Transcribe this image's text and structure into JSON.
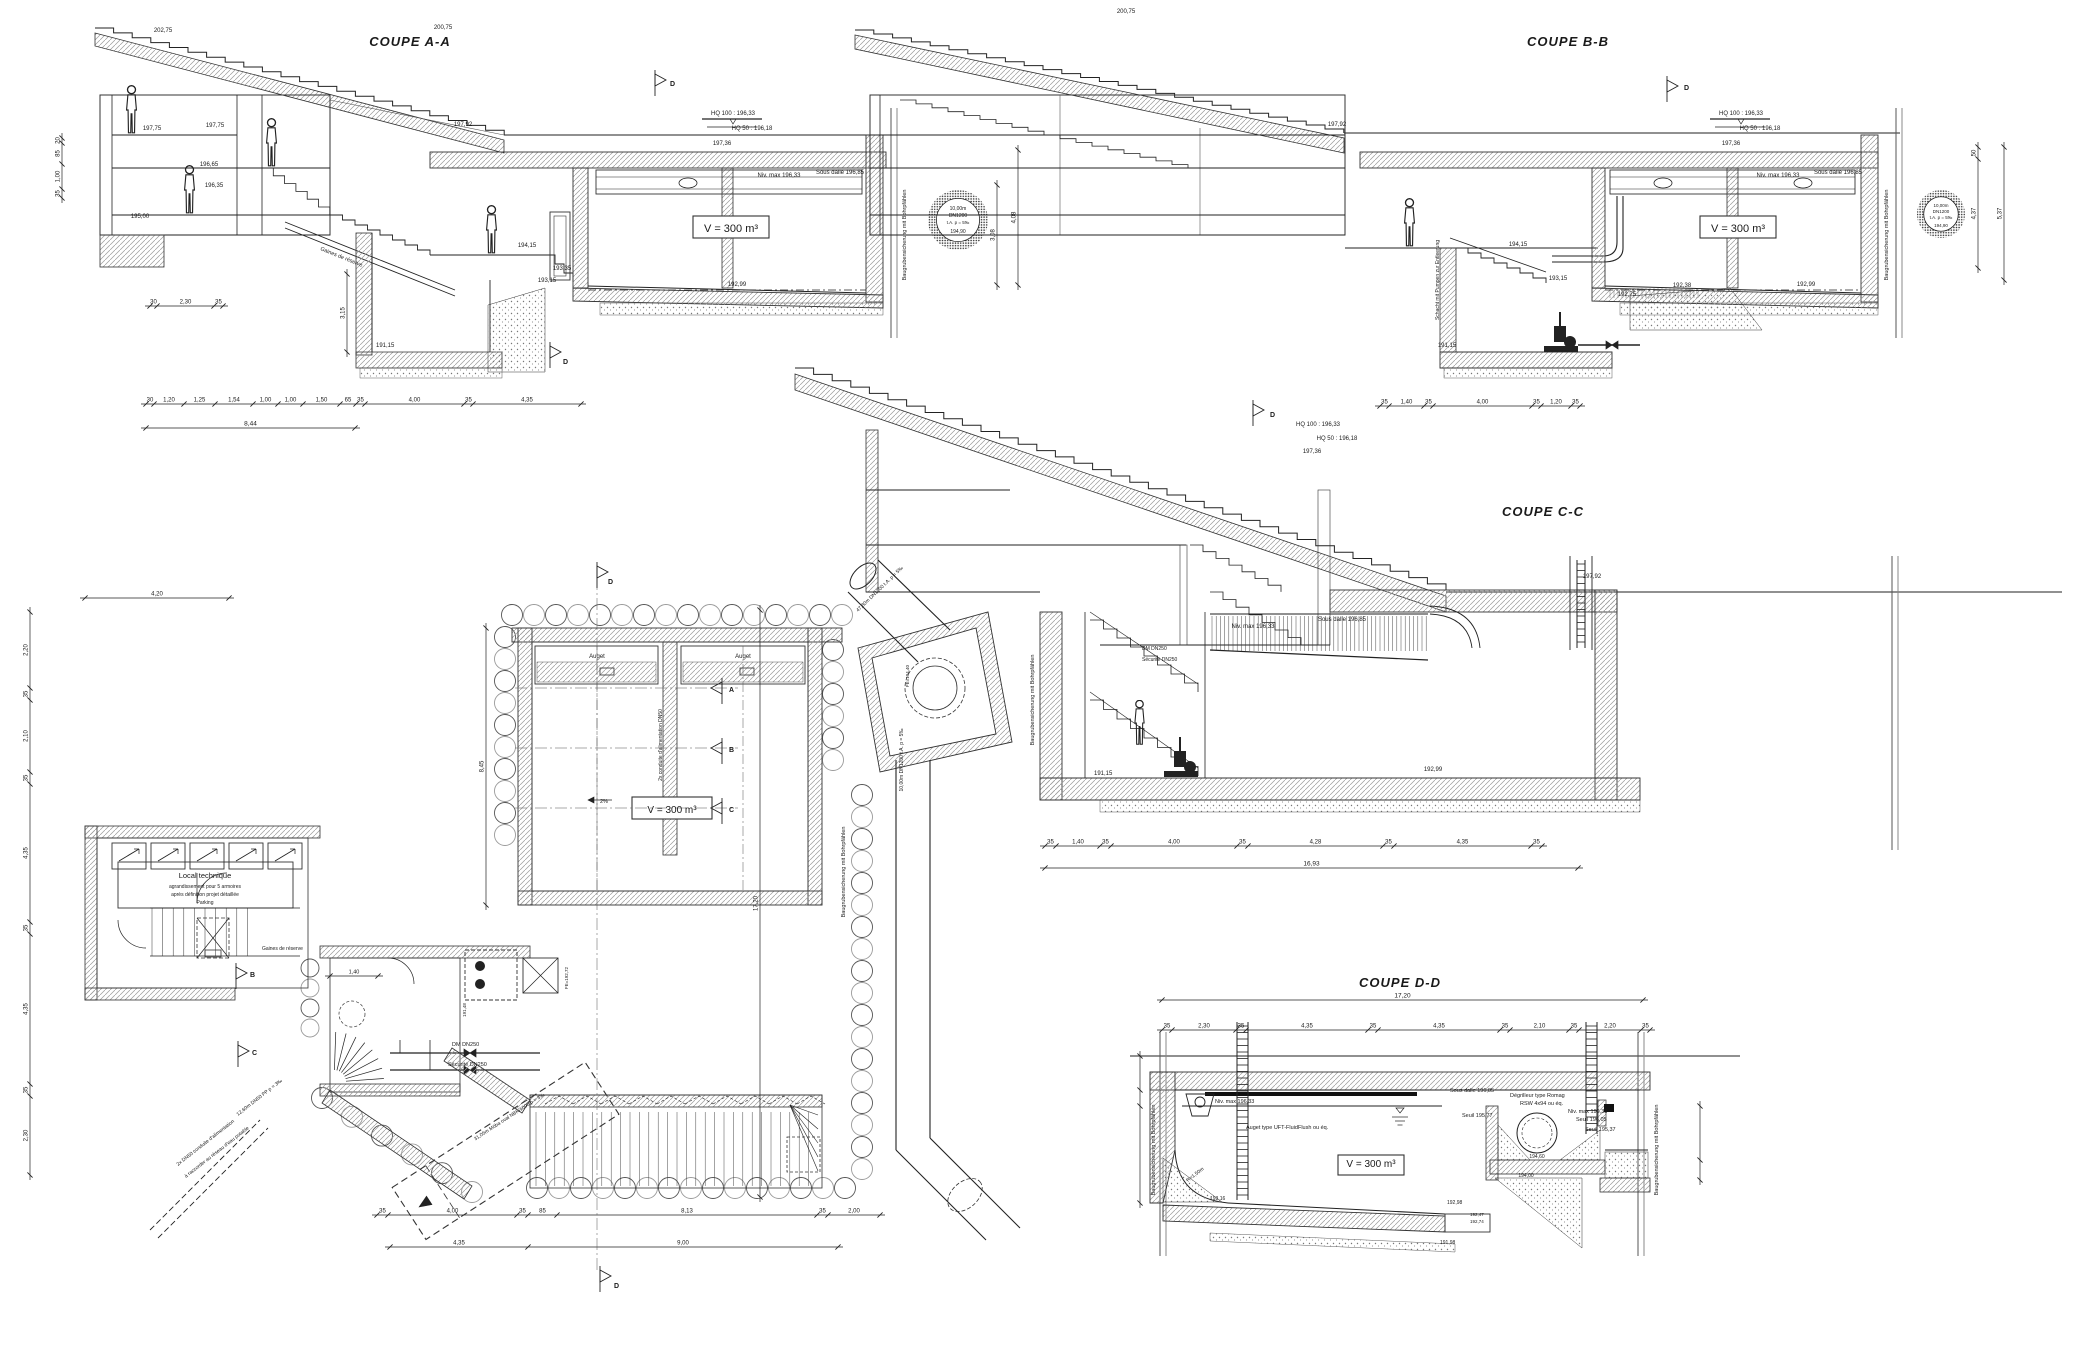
{
  "shared": {
    "volume": "V = 300 m³",
    "niv_max": "Niv. max 196,33",
    "sous_dalle": "Sous dalle 196,85",
    "hq100": "HQ 100 : 196,33",
    "hq50": "HQ 50 : 196,18",
    "l19736": "197,36",
    "l19792": "197,92",
    "baugruben": "Baugrubensicherung mit Bohrpfählen",
    "dm": "DM DN250",
    "secu": "Sécurité DN250",
    "flag_d": "D",
    "stamp": {
      "l1": "10,00m",
      "l2": "DN1200",
      "l3": "t.A. p = 5‰",
      "l4": "194,90"
    }
  },
  "aa": {
    "title": "COUPE A-A",
    "gaines": "Gaines de réserve",
    "total": [
      "8,44"
    ],
    "d315": [
      "3,15"
    ],
    "dims": [
      "30",
      "1,20",
      "1,25",
      "1,54",
      "1,00",
      "1,00",
      "1,50",
      "65",
      "35",
      "4,00",
      "35",
      "4,35"
    ],
    "footing": [
      "30",
      "2,30",
      "35"
    ],
    "left": [
      "20",
      "85",
      "1,00",
      "35"
    ],
    "r1": [
      "3,08"
    ],
    "r2": [
      "4,08"
    ],
    "levels": {
      "l20275": "202,75",
      "l20075": "200,75",
      "l19775": "197,75",
      "l19665": "196,65",
      "l19635": "196,35",
      "l19500": "195,00",
      "l19415": "194,15",
      "l19335": "193,35",
      "l19315": "193,15",
      "l19299": "192,99",
      "l19115": "191,15"
    }
  },
  "bb": {
    "title": "COUPE B-B",
    "schacht": "Schacht mit Pumpen zur Entleerung",
    "dims": [
      "35",
      "1,40",
      "35",
      "4,00",
      "35",
      "1,20",
      "35"
    ],
    "r1": [
      "50",
      "4,37"
    ],
    "r2": [
      "5,37"
    ],
    "levels": {
      "l20075": "200,75",
      "l19415": "194,15",
      "l19315": "193,15",
      "l19275": "192,75",
      "l19238": "192,38",
      "l19299": "192,99",
      "l19115": "191,15"
    }
  },
  "cc": {
    "title": "COUPE C-C",
    "dims": [
      "35",
      "1,40",
      "35",
      "4,00",
      "35",
      "4,28",
      "35",
      "4,35",
      "35"
    ],
    "total": [
      "16,93"
    ],
    "levels": {
      "l19115": "191,15",
      "l19299": "192,99"
    }
  },
  "dd": {
    "title": "COUPE D-D",
    "total": [
      "17,20"
    ],
    "dims": [
      "35",
      "2,30",
      "35",
      "4,35",
      "35",
      "4,35",
      "35",
      "2,10",
      "35",
      "2,20",
      "35"
    ],
    "degrilleur1": "Dégrilleur type Romag",
    "degrilleur2": "RSW 4x94 ou éq.",
    "auget": "Auget type UFT-FluidFlush ou éq.",
    "radius": "R=1,50m",
    "seuils": {
      "s1": "Seuil 196,05",
      "s2": "Seuil 195,77",
      "s3": "Seuil 195,37"
    },
    "levels": {
      "l19316": "193,16",
      "l19298": "192,98",
      "l19247": "192,47",
      "l19274": "192,74",
      "l19198": "191,98",
      "l19460": "194,60",
      "l19400": "194,00"
    }
  },
  "plan": {
    "local1": "Local technique",
    "local2": "agrandissement pour 5 armoires",
    "local3": "après définition projet détaillée",
    "local4": "Parking",
    "gaines": "Gaines de réserve",
    "auget": "Auget",
    "conduite": "2x conduite d'alimentation DN50",
    "pipe_in": "47,80m DN1200 t.A. p = 5‰",
    "pipe_down": "10,00m DN1200 t.A. p = 5‰",
    "pipe_out": "31,05m Möba oval NBK/1000 p = 3‰",
    "alim1": "2x DN50 conduite d'alimentation",
    "alim2": "à raccorder au réseau d'eau potable",
    "alim3": "12,60m DN50 PP p = 3‰",
    "fe19272": "FE=192,72",
    "fe19440": "FE=194,40",
    "l19148": "191,48",
    "d845": [
      "8,45"
    ],
    "d1720": [
      "17,20"
    ],
    "d420": [
      "4,20"
    ],
    "d140": [
      "1,40"
    ],
    "slope": "2%",
    "dims_bottom": [
      "35",
      "4,00",
      "35",
      "85",
      "8,13",
      "35",
      "2,00"
    ],
    "dims_bottom2": [
      "4,35",
      "9,00"
    ],
    "dims_left": [
      "2,20",
      "35",
      "2,10",
      "35",
      "4,35",
      "35",
      "4,35",
      "35",
      "2,30"
    ],
    "markers": {
      "a": "A",
      "b": "B",
      "c": "C",
      "d": "D"
    }
  }
}
